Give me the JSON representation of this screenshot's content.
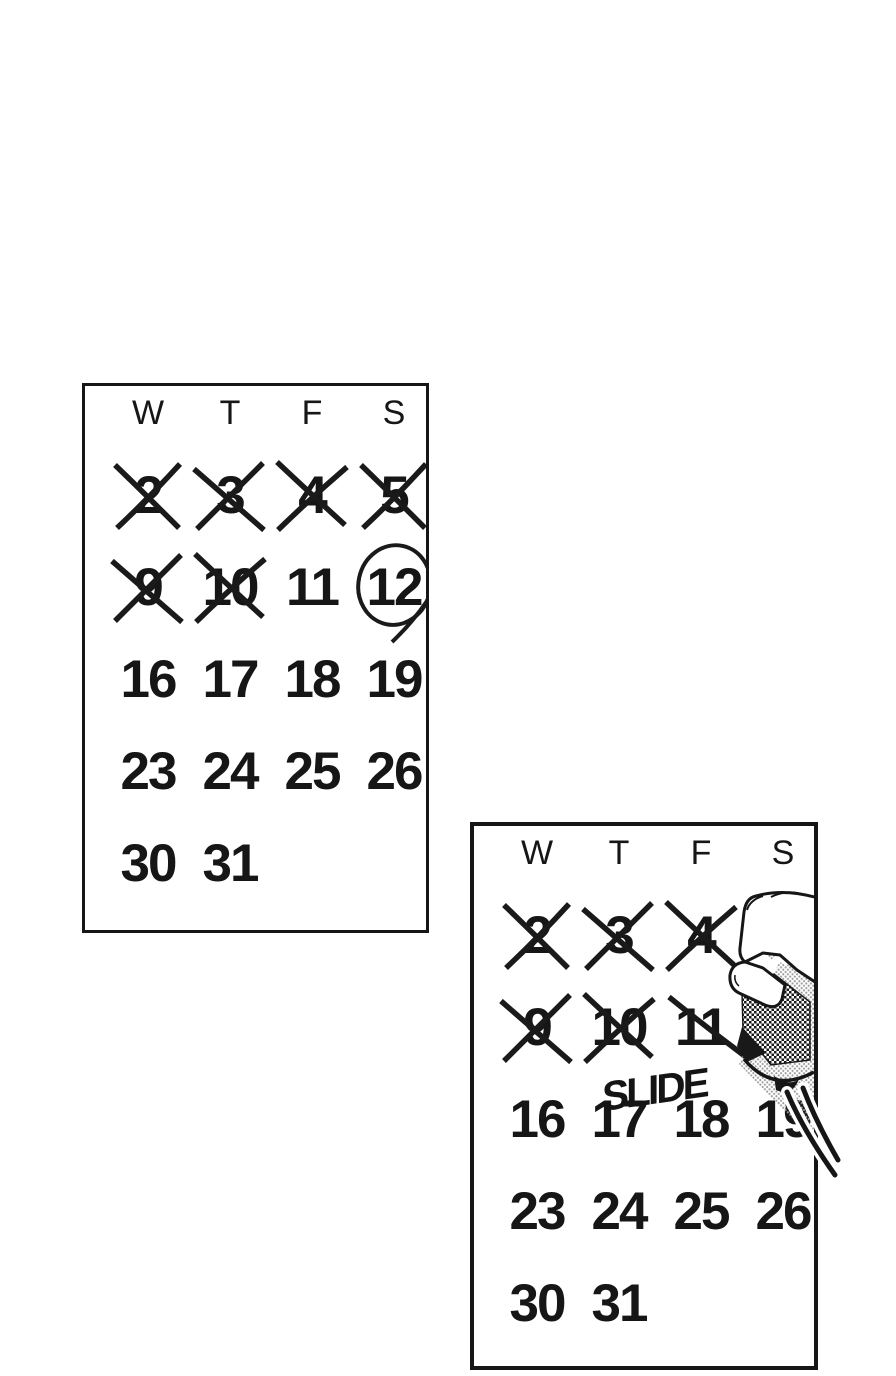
{
  "colors": {
    "ink": "#161616",
    "paper": "#ffffff",
    "tone_light": "#9b9b9b"
  },
  "calendars": [
    {
      "id": "first",
      "headers": [
        "W",
        "T",
        "F",
        "S"
      ],
      "weeks": [
        [
          {
            "d": "2",
            "mark": "cross"
          },
          {
            "d": "3",
            "mark": "cross"
          },
          {
            "d": "4",
            "mark": "cross"
          },
          {
            "d": "5",
            "mark": "cross"
          }
        ],
        [
          {
            "d": "9",
            "mark": "cross"
          },
          {
            "d": "10",
            "mark": "cross"
          },
          {
            "d": "11"
          },
          {
            "d": "12",
            "mark": "circle"
          }
        ],
        [
          {
            "d": "16"
          },
          {
            "d": "17"
          },
          {
            "d": "18"
          },
          {
            "d": "19"
          }
        ],
        [
          {
            "d": "23"
          },
          {
            "d": "24"
          },
          {
            "d": "25"
          },
          {
            "d": "26"
          }
        ],
        [
          {
            "d": "30"
          },
          {
            "d": "31"
          },
          null,
          null
        ]
      ]
    },
    {
      "id": "second",
      "headers": [
        "W",
        "T",
        "F",
        "S"
      ],
      "sfx": "SLIDE",
      "weeks": [
        [
          {
            "d": "2",
            "mark": "cross"
          },
          {
            "d": "3",
            "mark": "cross"
          },
          {
            "d": "4",
            "mark": "cross"
          },
          {
            "d": "5",
            "occluded": true
          }
        ],
        [
          {
            "d": "9",
            "mark": "cross"
          },
          {
            "d": "10",
            "mark": "cross"
          },
          {
            "d": "11",
            "mark": "stroke"
          },
          {
            "d": "12",
            "occluded": true
          }
        ],
        [
          {
            "d": "16"
          },
          {
            "d": "17"
          },
          {
            "d": "18"
          },
          {
            "d": "19",
            "occluded": "partial"
          }
        ],
        [
          {
            "d": "23"
          },
          {
            "d": "24"
          },
          {
            "d": "25"
          },
          {
            "d": "26"
          }
        ],
        [
          {
            "d": "30"
          },
          {
            "d": "31"
          },
          null,
          null
        ]
      ]
    }
  ]
}
